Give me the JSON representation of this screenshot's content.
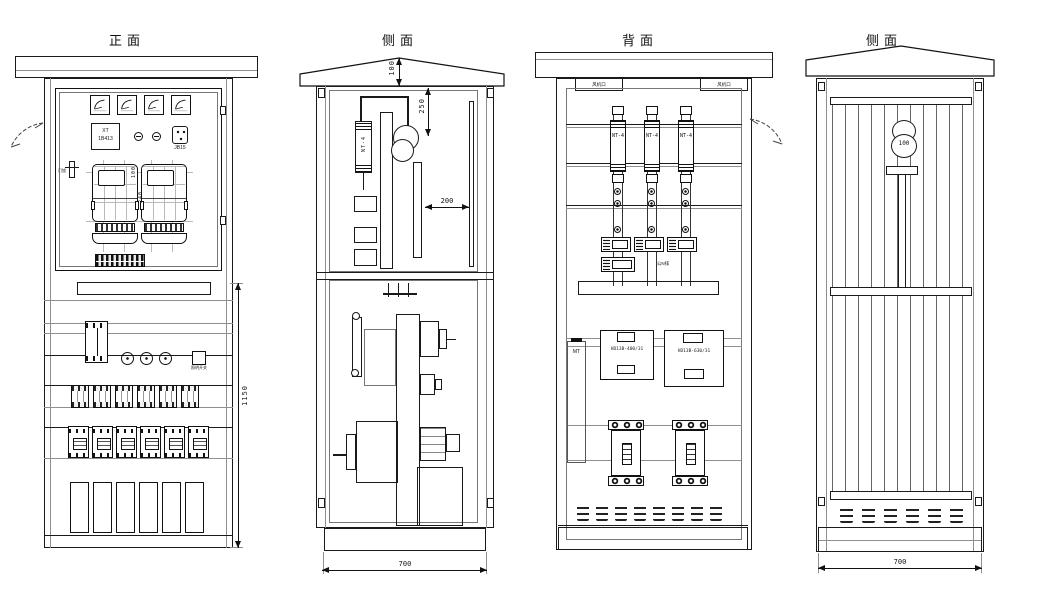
{
  "views": {
    "front": {
      "title": "正面",
      "nameplate_line1": "XT",
      "nameplate_line2": "1B413",
      "socket_label": "JB15",
      "lock_label": "门锁",
      "aux_label": "照明开关",
      "dim_meter_gap": "100",
      "dim_meter_height": "240",
      "dim_height": "1150",
      "counts": {
        "panel_meters": 4,
        "kwh_meters": 2,
        "mcbs": 6,
        "breakers": 6,
        "slots": 6
      }
    },
    "side_left": {
      "title": "侧面",
      "fuse_label": "NT-4",
      "dim_roof": "100",
      "dim_drop": "250",
      "dim_depth": "200",
      "dim_width": "700"
    },
    "back": {
      "title": "背面",
      "vent_left": "风机口",
      "vent_right": "风机口",
      "fuse_label": "NT-4",
      "bus_label": "公N排",
      "mt_label": "MT",
      "knife_left": "HD13B-400/31",
      "knife_right": "HD13B-630/31",
      "counts": {
        "fuse_columns": 3,
        "clamps": 3,
        "louvers": 8,
        "mccbs": 2
      }
    },
    "side_right": {
      "title": "侧面",
      "hole_label": "100",
      "dim_width": "700",
      "counts": {
        "louvers": 6
      }
    }
  }
}
